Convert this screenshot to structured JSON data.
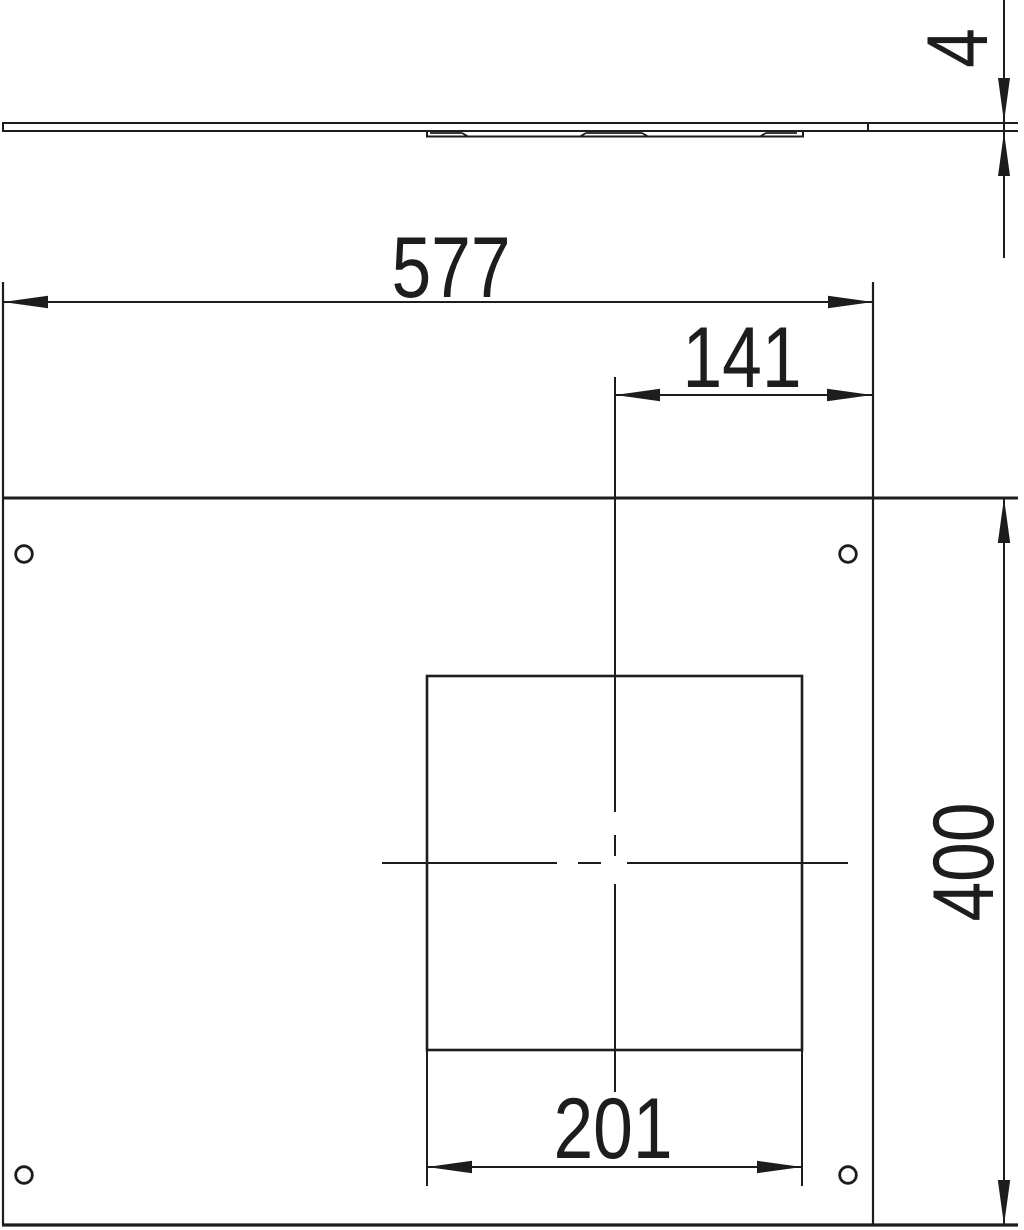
{
  "page": {
    "background": "#ffffff"
  },
  "drawing": {
    "line_color": "#1d1d1f",
    "side_view": {
      "thickness_label": "4"
    },
    "plan_view": {
      "overall_width_label": "577",
      "center_to_edge_label": "141",
      "overall_height_label": "400",
      "cutout_width_label": "201"
    }
  }
}
